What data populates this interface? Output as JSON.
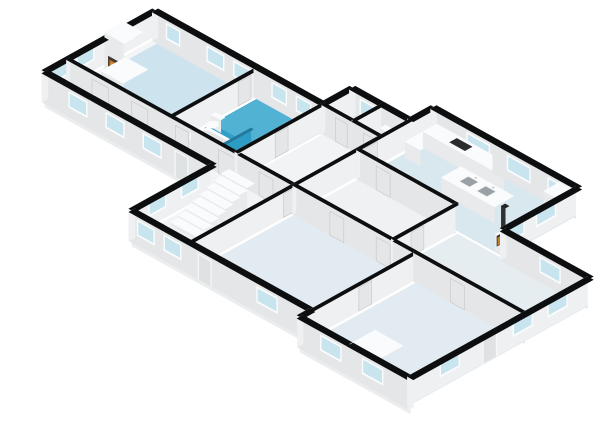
{
  "meta": {
    "app": "3d-floorplan-render",
    "view": "isometric-sw"
  },
  "projection": {
    "ax": 11.6,
    "ay": 6.45,
    "hz": 12.5,
    "ox": -71,
    "oy": 165,
    "wallH": 2.3
  },
  "palette": {
    "background": "#ffffff",
    "wall_top": "#0d0e0f",
    "wall_s": "#e4e6e8",
    "wall_w": "#eff0f2",
    "slab_s": "#ebedee",
    "slab_w": "#f4f5f6",
    "window_frame": "#fbfcfc",
    "window_glass": "#c8e4ee",
    "door_frame": "#f8f9f9",
    "door_panel": "#dfe2e3",
    "int_panel": "#e4e6e7",
    "panel_stroke": "#c9ccce",
    "fix_top": "#fafbfc",
    "fix_s": "#e8eaec",
    "fix_w": "#f1f2f4",
    "fire_dark": "#42382f",
    "fire_orange": "#bf7826",
    "fire_glow": "#e59b3b",
    "basin": "#9aa1a6",
    "cooktop": "#2b2d2f",
    "shower_glass": "#1d89b4",
    "bath_teal": "#2e9fc8",
    "bath_teal_light": "#51b2d4"
  },
  "slab": {
    "outline": [
      [
        0,
        10
      ],
      [
        0,
        19.5
      ],
      [
        14.5,
        19.5
      ],
      [
        14.5,
        22
      ],
      [
        19.5,
        22
      ],
      [
        19.5,
        24
      ],
      [
        32,
        24
      ],
      [
        32,
        17.5
      ],
      [
        39.5,
        17.5
      ],
      [
        39.5,
        2
      ],
      [
        30,
        2
      ],
      [
        30,
        3
      ],
      [
        14.5,
        3
      ],
      [
        14.5,
        10
      ]
    ],
    "depth": 0.55
  },
  "rooms": [
    {
      "name": "living-room",
      "rect": [
        0.45,
        12.15,
        8.75,
        19.32
      ],
      "color": "#cde4ef"
    },
    {
      "name": "bathroom",
      "rect": [
        9.05,
        12.15,
        14.38,
        19.32
      ],
      "color": "#2e9fc8"
    },
    {
      "name": "hallway-west",
      "rect": [
        0.45,
        10.35,
        19.35,
        11.85
      ],
      "color": "#f3f4f5"
    },
    {
      "name": "hall-center",
      "rect": [
        14.65,
        3.3,
        19.35,
        19.32
      ],
      "color": "#f2f3f4"
    },
    {
      "name": "storage-north-1",
      "rect": [
        14.65,
        19.65,
        16.95,
        21.85
      ],
      "color": "#f4f5f6"
    },
    {
      "name": "toilet-room-north",
      "rect": [
        17.25,
        19.65,
        19.35,
        21.85
      ],
      "color": "#f4f5f6"
    },
    {
      "name": "kitchen",
      "rect": [
        19.65,
        17.65,
        31.85,
        23.85
      ],
      "color": "#d9e8ef"
    },
    {
      "name": "hall-east",
      "rect": [
        19.65,
        12.15,
        27.85,
        17.42
      ],
      "color": "#eff1f3"
    },
    {
      "name": "room-east",
      "rect": [
        28.15,
        12.15,
        39.35,
        17.42
      ],
      "color": "#e5edf1"
    },
    {
      "name": "room-south",
      "rect": [
        19.65,
        3.15,
        29.85,
        11.85
      ],
      "color": "#e2ebf1"
    },
    {
      "name": "room-southeast",
      "rect": [
        30.15,
        2.15,
        39.35,
        11.85
      ],
      "color": "#e2ebf1"
    }
  ],
  "overlays": [
    {
      "name": "bathroom-light-zone",
      "rect": [
        9.1,
        15.4,
        14.38,
        19.32
      ],
      "color": "#51b2d4"
    }
  ],
  "walls": [
    {
      "name": "ext-west-nw",
      "x1": 0,
      "y1": 10,
      "x2": 0,
      "y2": 19.5,
      "t": 0.5,
      "windows": [
        {
          "at": 0.8,
          "w": 1.5
        },
        {
          "at": 3.0,
          "w": 1.5
        },
        {
          "at": 6.6,
          "w": 1.4
        }
      ]
    },
    {
      "name": "ext-north-nw",
      "x1": 0,
      "y1": 19.5,
      "x2": 14.5,
      "y2": 19.5,
      "t": 0.5,
      "windows": [
        {
          "at": 1.2,
          "w": 1.2
        },
        {
          "at": 4.7,
          "w": 1.5
        },
        {
          "at": 7.0,
          "w": 1.5
        },
        {
          "at": 10.3,
          "w": 1.3
        },
        {
          "at": 12.4,
          "w": 1.3
        }
      ]
    },
    {
      "name": "ext-step-west",
      "x1": 14.5,
      "y1": 19.5,
      "x2": 14.5,
      "y2": 22,
      "t": 0.5,
      "windows": []
    },
    {
      "name": "ext-north-mid",
      "x1": 14.5,
      "y1": 22,
      "x2": 19.5,
      "y2": 22,
      "t": 0.5,
      "windows": [
        {
          "at": 0.9,
          "w": 1.3
        }
      ]
    },
    {
      "name": "ext-step-kitchen",
      "x1": 19.5,
      "y1": 22,
      "x2": 19.5,
      "y2": 24,
      "t": 0.5,
      "windows": []
    },
    {
      "name": "ext-north-kitchen",
      "x1": 19.5,
      "y1": 24,
      "x2": 32,
      "y2": 24,
      "t": 0.5,
      "windows": [
        {
          "at": 3.1,
          "w": 2.0
        },
        {
          "at": 6.6,
          "w": 2.0
        },
        {
          "at": 10.1,
          "w": 1.6
        }
      ]
    },
    {
      "name": "ext-east-kitchen",
      "x1": 32,
      "y1": 24,
      "x2": 32,
      "y2": 17.5,
      "t": 0.5,
      "windows": [
        {
          "at": 1.7,
          "w": 1.7
        },
        {
          "at": 4.4,
          "w": 1.4
        }
      ]
    },
    {
      "name": "ext-north-room-east",
      "x1": 32,
      "y1": 17.5,
      "x2": 39.5,
      "y2": 17.5,
      "t": 0.5,
      "windows": [
        {
          "at": 3.4,
          "w": 1.8
        }
      ]
    },
    {
      "name": "ext-east",
      "x1": 39.5,
      "y1": 17.5,
      "x2": 39.5,
      "y2": 2,
      "t": 0.5,
      "windows": [
        {
          "at": 1.7,
          "w": 1.7
        },
        {
          "at": 4.7,
          "w": 1.7
        },
        {
          "at": 11.0,
          "w": 1.7
        }
      ],
      "doors": [
        {
          "at": 7.8,
          "w": 1.2
        }
      ]
    },
    {
      "name": "ext-south-se",
      "x1": 39.5,
      "y1": 2,
      "x2": 30,
      "y2": 2,
      "t": 0.5,
      "windows": [
        {
          "at": 2.1,
          "w": 1.8
        },
        {
          "at": 5.7,
          "w": 1.8
        }
      ]
    },
    {
      "name": "ext-step-south",
      "x1": 30,
      "y1": 2,
      "x2": 30,
      "y2": 3,
      "t": 0.5,
      "windows": []
    },
    {
      "name": "ext-south-mid",
      "x1": 30,
      "y1": 3,
      "x2": 14.5,
      "y2": 3,
      "t": 0.5,
      "windows": [
        {
          "at": 2.7,
          "w": 1.8
        },
        {
          "at": 11.0,
          "w": 1.5
        },
        {
          "at": 13.3,
          "w": 1.5
        }
      ],
      "doors": [
        {
          "at": 8.4,
          "w": 1.15
        }
      ]
    },
    {
      "name": "ext-west-center",
      "x1": 14.5,
      "y1": 3,
      "x2": 14.5,
      "y2": 10,
      "t": 0.5,
      "windows": [
        {
          "at": 1.7,
          "w": 1.5
        },
        {
          "at": 4.5,
          "w": 1.5
        }
      ]
    },
    {
      "name": "ext-south-nw",
      "x1": 14.5,
      "y1": 10,
      "x2": 0,
      "y2": 10,
      "t": 0.5,
      "windows": [
        {
          "at": 4.2,
          "w": 1.6
        },
        {
          "at": 7.4,
          "w": 1.6
        },
        {
          "at": 10.6,
          "w": 1.6
        }
      ],
      "doors": [
        {
          "at": 1.9,
          "w": 1.15
        }
      ]
    },
    {
      "name": "int-living-bath",
      "x1": 8.9,
      "y1": 12,
      "x2": 8.9,
      "y2": 19.5,
      "t": 0.28,
      "panels": [
        {
          "at": 5.9,
          "w": 1.1
        }
      ]
    },
    {
      "name": "int-corridor-north",
      "x1": 0,
      "y1": 12,
      "x2": 19.5,
      "y2": 12,
      "t": 0.28,
      "panels": [
        {
          "at": 2.2,
          "w": 1.4
        },
        {
          "at": 5.6,
          "w": 1.4
        },
        {
          "at": 9.4,
          "w": 1.1
        },
        {
          "at": 13.1,
          "w": 1.4
        },
        {
          "at": 16.6,
          "w": 1.2
        }
      ]
    },
    {
      "name": "int-bath-east",
      "x1": 14.5,
      "y1": 12,
      "x2": 14.5,
      "y2": 19.5,
      "t": 0.28,
      "panels": [
        {
          "at": 3.5,
          "w": 1.1
        }
      ]
    },
    {
      "name": "int-center-east",
      "x1": 19.5,
      "y1": 3,
      "x2": 19.5,
      "y2": 22,
      "t": 0.28,
      "panels": [
        {
          "at": 8.2,
          "w": 1.2
        },
        {
          "at": 15.2,
          "w": 1.1
        }
      ]
    },
    {
      "name": "int-north-rooms-south",
      "x1": 14.5,
      "y1": 19.5,
      "x2": 19.5,
      "y2": 19.5,
      "t": 0.28,
      "panels": [
        {
          "at": 1.2,
          "w": 1.0
        },
        {
          "at": 3.6,
          "w": 1.0
        }
      ]
    },
    {
      "name": "int-north-rooms-div",
      "x1": 17.1,
      "y1": 19.5,
      "x2": 17.1,
      "y2": 22,
      "t": 0.28
    },
    {
      "name": "int-kitchen-south",
      "x1": 19.5,
      "y1": 17.5,
      "x2": 28,
      "y2": 17.5,
      "t": 0.28,
      "panels": [
        {
          "at": 1.7,
          "w": 1.2
        }
      ]
    },
    {
      "name": "int-mid-long",
      "x1": 19.5,
      "y1": 12,
      "x2": 39.5,
      "y2": 12,
      "t": 0.28,
      "panels": [
        {
          "at": 3.2,
          "w": 1.2
        },
        {
          "at": 7.2,
          "w": 1.2
        },
        {
          "at": 13.6,
          "w": 1.2
        }
      ]
    },
    {
      "name": "int-room-east-west",
      "x1": 28,
      "y1": 12,
      "x2": 28,
      "y2": 17.5,
      "t": 0.28,
      "panels": [
        {
          "at": 1.7,
          "w": 1.1
        }
      ]
    },
    {
      "name": "int-south-div",
      "x1": 30,
      "y1": 2,
      "x2": 30,
      "y2": 12,
      "t": 0.28,
      "panels": [
        {
          "at": 5.2,
          "w": 1.1
        }
      ]
    }
  ],
  "stairs": {
    "name": "staircase",
    "x1": 15.15,
    "x2": 17.35,
    "y0": 5.7,
    "dy": 0.62,
    "n": 8,
    "h0": 0.3,
    "dh": 0.235
  },
  "fixtures": [
    {
      "name": "fireplace-hearth",
      "type": "box",
      "rect": [
        0.4,
        14.45,
        2.3,
        16.55
      ],
      "h": 0.28
    },
    {
      "name": "fireplace",
      "type": "box",
      "rect": [
        0.45,
        14.7,
        2.05,
        16.35
      ],
      "h": 3.25,
      "decals": [
        {
          "plane": "y",
          "at": 14.7,
          "a1": 0.8,
          "a2": 1.7,
          "z0": 0.5,
          "z1": 1.55,
          "color": "#42382f"
        },
        {
          "plane": "y",
          "at": 14.7,
          "a1": 0.92,
          "a2": 1.58,
          "z0": 0.55,
          "z1": 1.3,
          "color": "#bf7826"
        },
        {
          "plane": "y",
          "at": 14.7,
          "a1": 1.02,
          "a2": 1.48,
          "z0": 0.6,
          "z1": 1.12,
          "color": "#e59b3b"
        }
      ]
    },
    {
      "name": "bathtub",
      "type": "oct",
      "rect": [
        9.55,
        12.45,
        12.7,
        14.2
      ],
      "cut": 0.5,
      "h": 0.78,
      "topDecals": [
        {
          "rectOct": [
            9.85,
            12.75,
            12.4,
            13.95
          ],
          "cut": 0.38,
          "color": "#e2e7e9"
        }
      ]
    },
    {
      "name": "shower-glass-panel",
      "type": "box",
      "rect": [
        12.85,
        12.3,
        13.05,
        14.9
      ],
      "h": 1.9,
      "colors": {
        "top": "#25789c",
        "s": "#1d89b4",
        "w": "#2d9cc4"
      }
    },
    {
      "name": "toilet-tank",
      "type": "box",
      "rect": [
        9.25,
        15.1,
        10.05,
        15.45
      ],
      "h": 1.0
    },
    {
      "name": "toilet-bowl",
      "type": "oct",
      "rect": [
        9.3,
        14.35,
        10.0,
        15.2
      ],
      "cut": 0.26,
      "h": 0.58
    },
    {
      "name": "kitchen-island",
      "type": "box",
      "rect": [
        24.3,
        19.9,
        28.85,
        21.55
      ],
      "h": 1.28,
      "topDecals": [
        {
          "rect": [
            25.35,
            20.3,
            26.3,
            21.15
          ],
          "color": "#9aa1a6",
          "stroke": "#f6f8f8"
        },
        {
          "rect": [
            26.85,
            20.3,
            27.8,
            21.15
          ],
          "color": "#9aa1a6",
          "stroke": "#f6f8f8"
        },
        {
          "circle": [
            25.82,
            21.32,
            0.09
          ],
          "color": "#c2c7c9"
        },
        {
          "circle": [
            27.32,
            21.32,
            0.09
          ],
          "color": "#c2c7c9"
        }
      ]
    },
    {
      "name": "kitchen-counter-north",
      "type": "box",
      "rect": [
        19.95,
        22.65,
        26.9,
        23.82
      ],
      "h": 1.28,
      "topDecals": [
        {
          "rect": [
            21.95,
            22.95,
            23.25,
            23.55
          ],
          "color": "#2b2d2f"
        }
      ]
    },
    {
      "name": "kitchen-counter-west",
      "type": "box",
      "rect": [
        19.95,
        21.1,
        21.25,
        22.65
      ],
      "h": 1.28
    },
    {
      "name": "fridge",
      "type": "box",
      "rect": [
        30.55,
        22.45,
        31.8,
        23.8
      ],
      "h": 2.1
    },
    {
      "name": "wood-stove",
      "type": "box",
      "rect": [
        31.05,
        17.78,
        31.88,
        18.62
      ],
      "h": 1.3,
      "decals": [
        {
          "plane": "x",
          "at": 31.05,
          "a1": 17.95,
          "a2": 18.45,
          "z0": 0.25,
          "z1": 1.05,
          "color": "#3a332c"
        },
        {
          "plane": "x",
          "at": 31.05,
          "a1": 18.02,
          "a2": 18.38,
          "z0": 0.3,
          "z1": 0.88,
          "color": "#c57c27"
        }
      ]
    },
    {
      "name": "stove-pipe",
      "type": "box",
      "rect": [
        31.3,
        18.05,
        31.62,
        18.37
      ],
      "z0": 1.3,
      "h": 2.25,
      "colors": {
        "top": "#232425",
        "s": "#303132",
        "w": "#3a3b3c"
      }
    },
    {
      "name": "cabinet-southeast",
      "type": "box",
      "rect": [
        33.8,
        2.5,
        36.2,
        4.65
      ],
      "h": 1.82
    },
    {
      "name": "washbasin-ledge",
      "type": "box",
      "rect": [
        17.55,
        21.35,
        19.15,
        21.8
      ],
      "h": 1.0
    }
  ]
}
